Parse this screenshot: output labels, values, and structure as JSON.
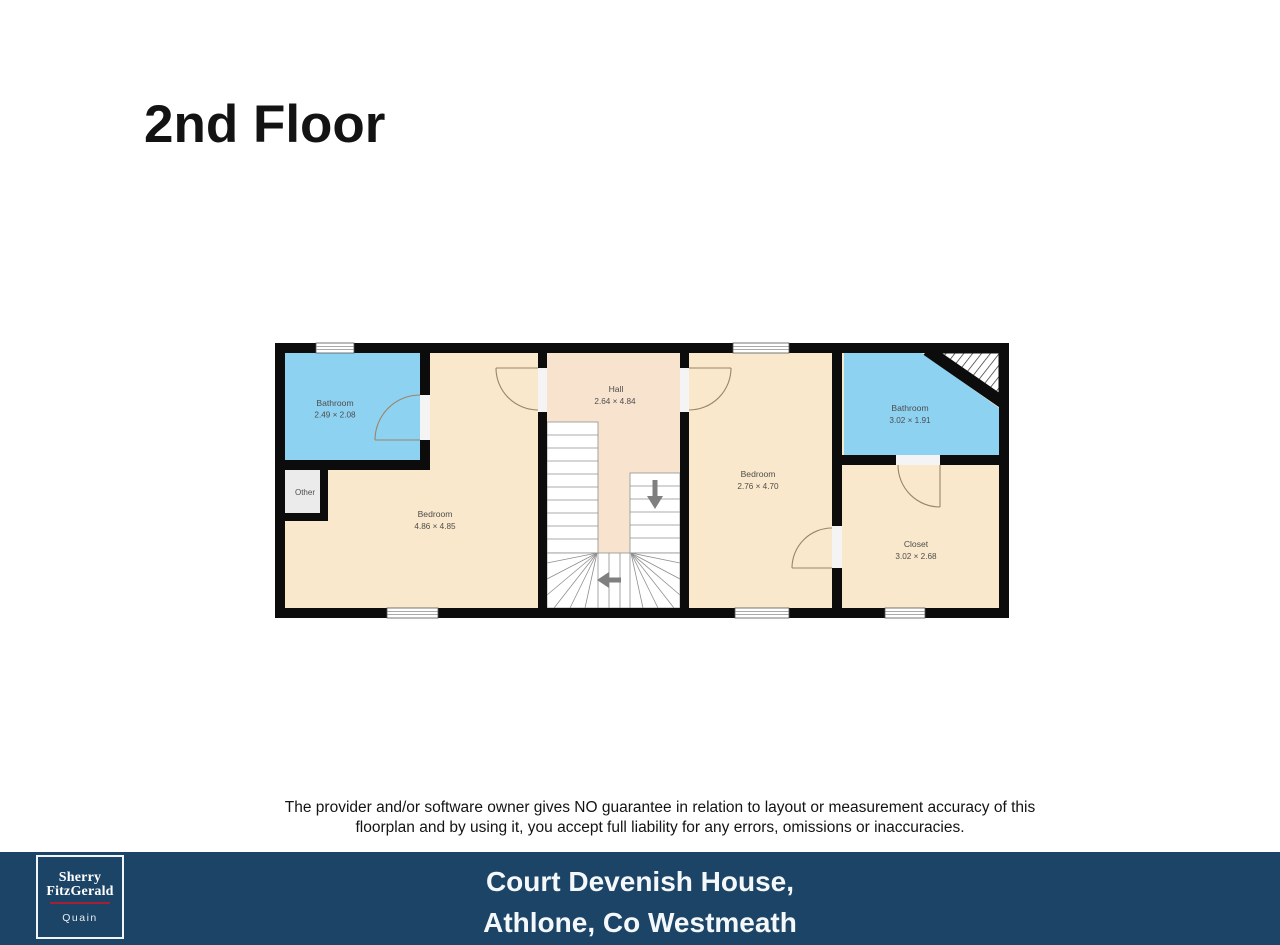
{
  "title": "2nd Floor",
  "floorplan": {
    "colors": {
      "wall": "#0c0c0c",
      "room_cream": "#f9e8cb",
      "hall_floor": "#f8e3cf",
      "bathroom_blue": "#8ed2f2",
      "other_grey": "#ebebeb",
      "door_arc": "#9b8468",
      "stair_arrow": "#7f7f7f"
    },
    "rooms": {
      "bathroom_left": {
        "name": "Bathroom",
        "dims": "2.49 × 2.08"
      },
      "other": {
        "name": "Other"
      },
      "bedroom_left": {
        "name": "Bedroom",
        "dims": "4.86 × 4.85"
      },
      "hall": {
        "name": "Hall",
        "dims": "2.64 × 4.84"
      },
      "bedroom_right": {
        "name": "Bedroom",
        "dims": "2.76 × 4.70"
      },
      "bathroom_right": {
        "name": "Bathroom",
        "dims": "3.02 × 1.91"
      },
      "closet": {
        "name": "Closet",
        "dims": "3.02 × 2.68"
      }
    }
  },
  "disclaimer": {
    "line1": "The provider and/or software owner gives NO guarantee in relation to layout or measurement accuracy of this",
    "line2": "floorplan and by using it, you accept full liability for any errors, omissions or inaccuracies."
  },
  "footer": {
    "background": "#1c4466",
    "address_line1": "Court Devenish House,",
    "address_line2": "Athlone, Co Westmeath",
    "logo": {
      "brand_line1": "Sherry",
      "brand_line2": "FitzGerald",
      "sub": "Quain",
      "rule_color": "#a51f35"
    }
  }
}
